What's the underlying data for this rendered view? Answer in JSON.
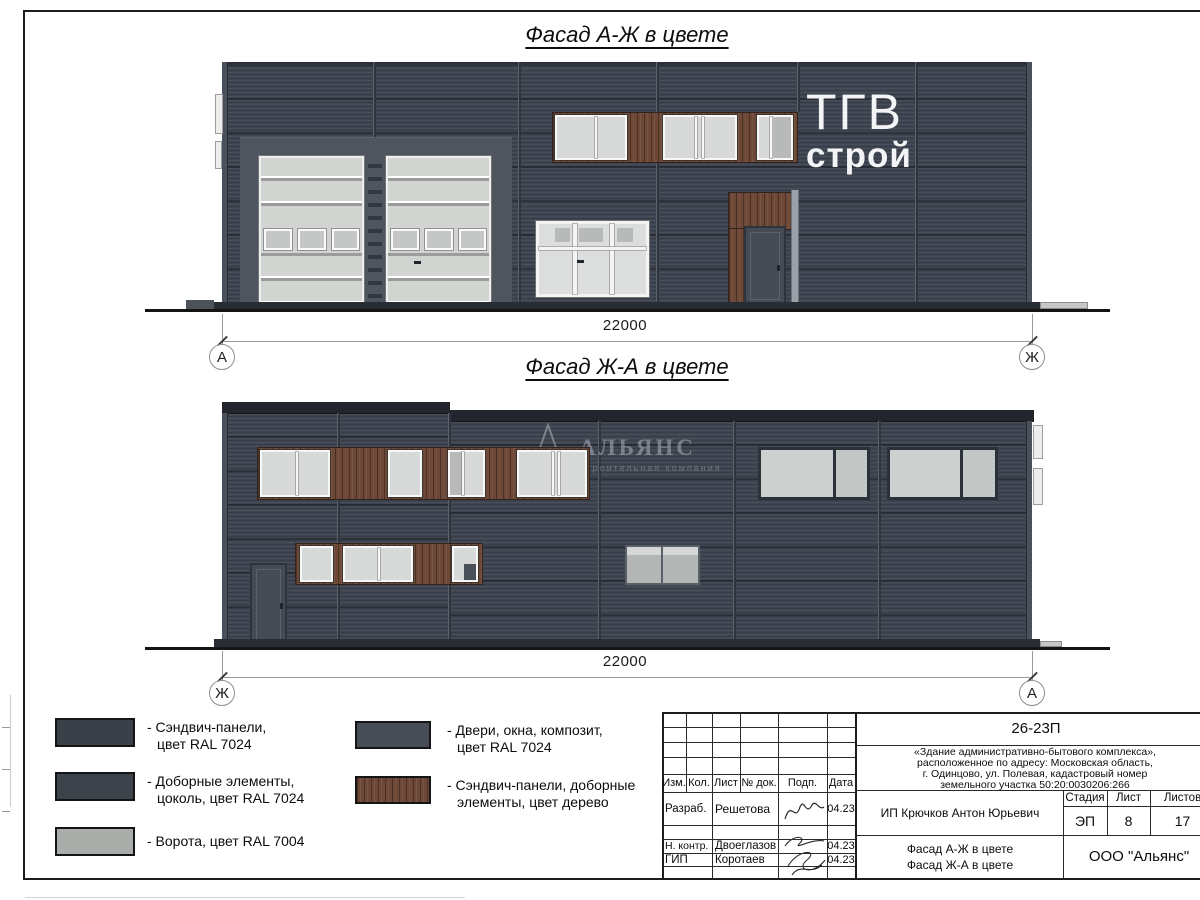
{
  "facade1": {
    "title": "Фасад А-Ж в цвете",
    "dimension": "22000",
    "axis_left": "А",
    "axis_right": "Ж",
    "sign_line1": "ТГВ",
    "sign_line2": "строй"
  },
  "facade2": {
    "title": "Фасад Ж-А в цвете",
    "dimension": "22000",
    "axis_left": "Ж",
    "axis_right": "А",
    "watermark_title": "АЛЬЯНС",
    "watermark_subtitle": "строительная компания"
  },
  "legend": {
    "items": [
      {
        "line1": "- Сэндвич-панели,",
        "line2": "цвет RAL 7024",
        "swatch": "#3a4047"
      },
      {
        "line1": "- Доборные элементы,",
        "line2": "цоколь, цвет RAL 7024",
        "swatch": "#3d434a"
      },
      {
        "line1": "- Ворота, цвет RAL 7004",
        "line2": "",
        "swatch": "#a9aeab"
      },
      {
        "line1": "- Двери, окна, композит,",
        "line2": "цвет RAL 7024",
        "swatch": "#474d55"
      },
      {
        "line1": "- Сэндвич-панели, доборные",
        "line2": "элементы, цвет дерево",
        "swatch": "#6d4837"
      }
    ]
  },
  "titleblock": {
    "code": "26-23П",
    "project_line1": "«Здание административно-бытового комплекса»,",
    "project_line2": "расположенное по адресу: Московская область,",
    "project_line3": "г. Одинцово, ул. Полевая, кадастровый номер",
    "project_line4": "земельного участка 50:20:0030206:266",
    "col_izm": "Изм.",
    "col_kol": "Кол.",
    "col_list": "Лист",
    "col_doc": "№ док.",
    "col_podp": "Подп.",
    "col_data": "Дата",
    "row1_role": "Разраб.",
    "row1_name": "Решетова",
    "row1_date": "04.23",
    "row2_role": "Н. контр.",
    "row2_name": "Двоеглазов",
    "row2_date": "04.23",
    "row3_role": "ГИП",
    "row3_name": "Коротаев",
    "row3_date": "04.23",
    "client": "ИП Крючков Антон Юрьевич",
    "stage_label": "Стадия",
    "sheet_label": "Лист",
    "sheets_label": "Листов",
    "stage": "ЭП",
    "sheet_no": "8",
    "sheets_total": "17",
    "doc_title_line1": "Фасад А-Ж в цвете",
    "doc_title_line2": "Фасад Ж-А в цвете",
    "company": "ООО \"Альянс\""
  }
}
